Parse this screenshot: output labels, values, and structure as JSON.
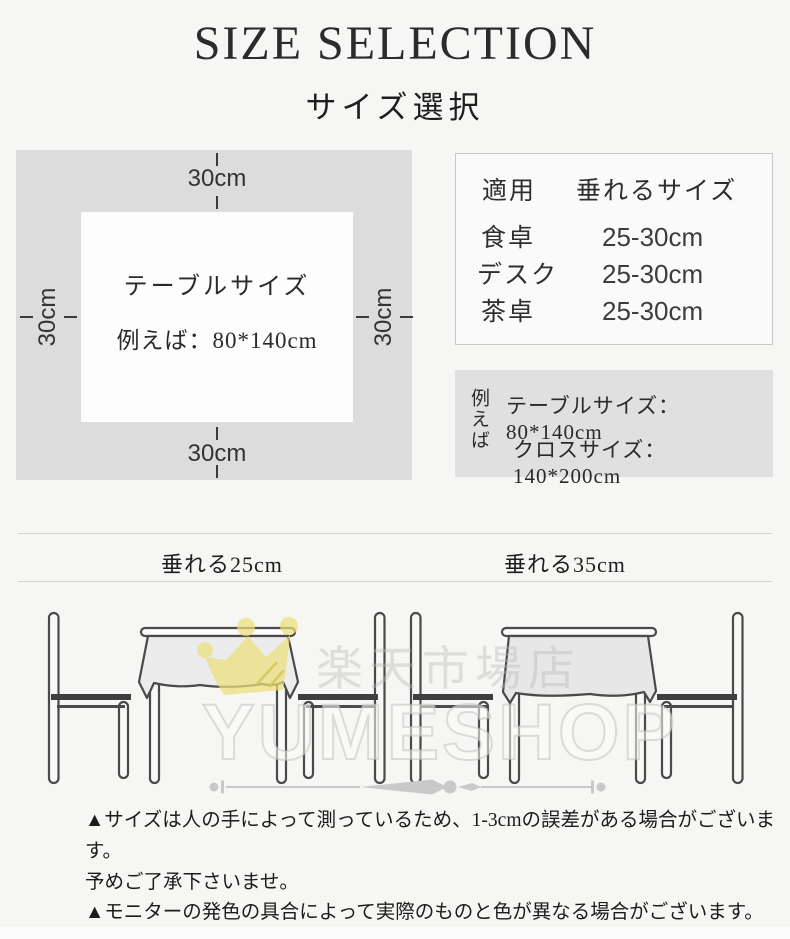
{
  "page": {
    "title": "SIZE SELECTION",
    "subtitle": "サイズ選択"
  },
  "diagram": {
    "margin_top": "30cm",
    "margin_bottom": "30cm",
    "margin_left": "30cm",
    "margin_right": "30cm",
    "table_label": "テーブルサイズ",
    "table_example": "例えば：80*140cm"
  },
  "size_table": {
    "headers": [
      "適用",
      "垂れるサイズ"
    ],
    "rows": [
      {
        "use": "食卓",
        "drop": "25-30cm"
      },
      {
        "use": "デスク",
        "drop": "25-30cm"
      },
      {
        "use": "茶卓",
        "drop": "25-30cm"
      }
    ]
  },
  "example_box": {
    "prefix": "例えば",
    "line1": "テーブルサイズ：80*140cm",
    "line2": "クロスサイズ：140*200cm"
  },
  "drapes": {
    "left_label": "垂れる25cm",
    "right_label": "垂れる35cm"
  },
  "watermark": {
    "shop_jp": "楽天市場店",
    "shop_en": "YUMESHOP"
  },
  "notes": [
    "▲サイズは人の手によって測っているため、1-3cmの誤差がある場合がございます。",
    "予めご了承下さいませ。",
    "▲モニターの発色の具合によって実際のものと色が異なる場合がございます。",
    "実際の商品に近いカラーはカラーバリエーションをご参考にしてください。"
  ],
  "colors": {
    "page_bg": "#f6f6f4",
    "diagram_bg": "#dcdcdc",
    "inner_bg": "#fdfdfd",
    "example_bg": "#e0e0e0",
    "crown_yellow": "#e9dd7a",
    "line_art": "#4a4a4a",
    "text": "#2a2a2a"
  }
}
